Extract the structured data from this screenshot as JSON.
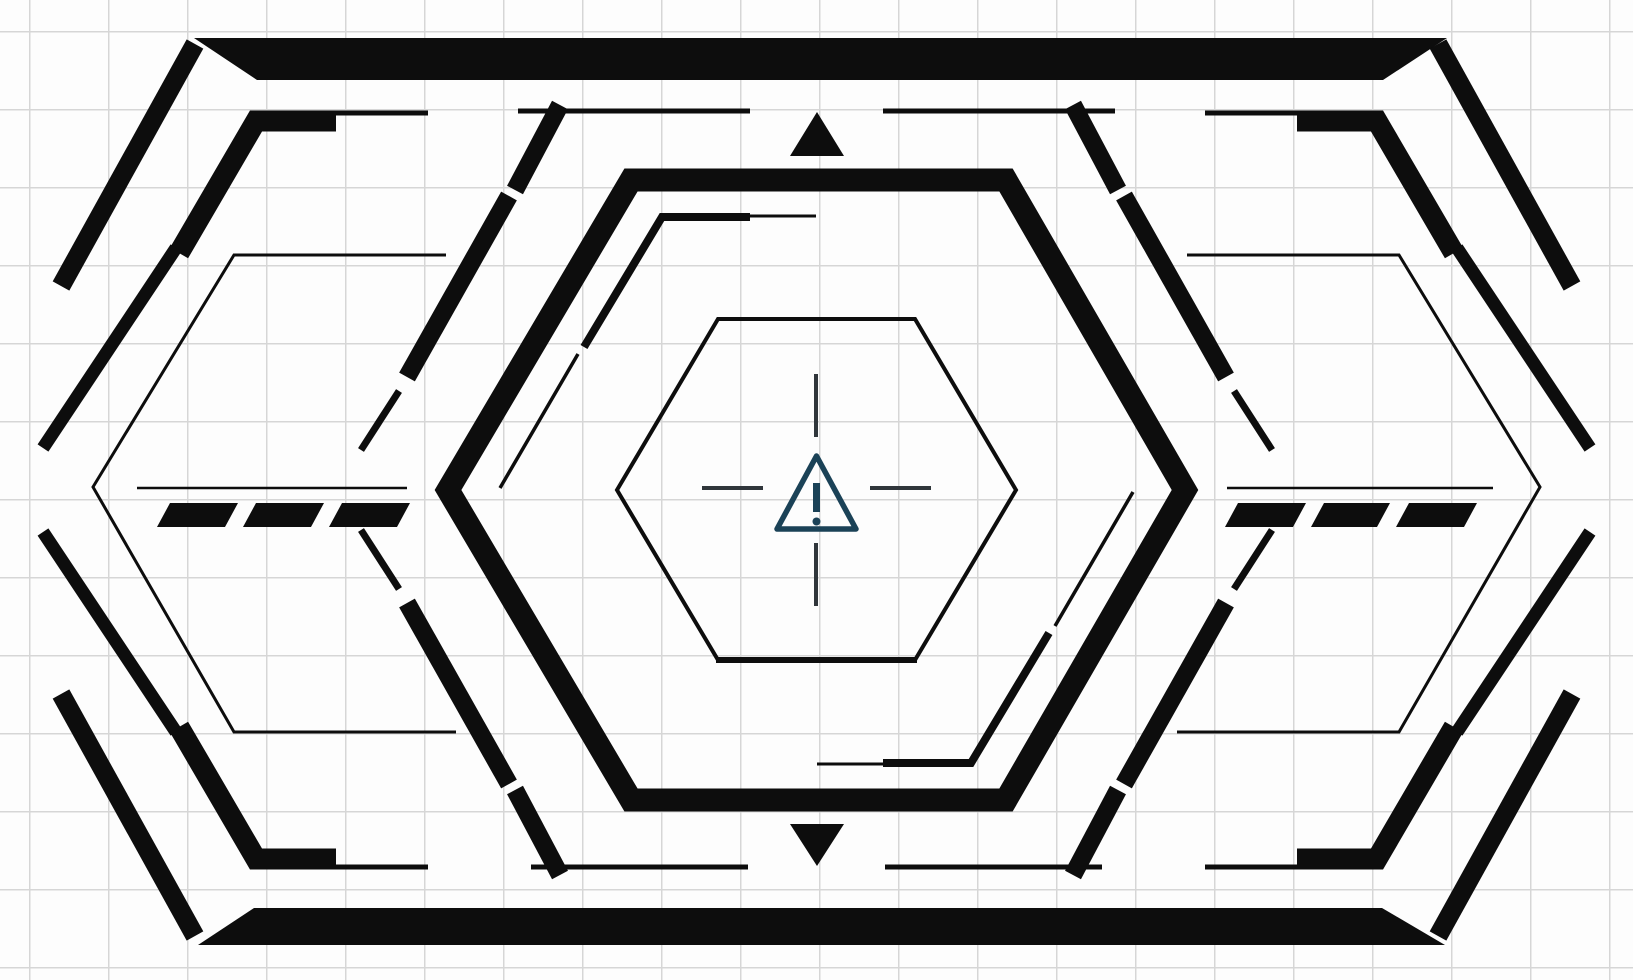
{
  "scene": {
    "title": "Sci-fi HUD hexagonal frame with warning sign on graph paper",
    "canvas": {
      "width": 1633,
      "height": 980
    },
    "colors": {
      "background": "#fdfdfd",
      "grid_line": "#d6d6d6",
      "ink": "#0d0d0d",
      "crosshair": "#30363b",
      "warning": "#1b4257"
    },
    "grid": {
      "cell_w": 79,
      "cell_h": 78,
      "offset_x": 29,
      "offset_y": 31
    },
    "icons": {
      "center": "warning-triangle-icon",
      "top": "up-arrow-icon",
      "bottom": "down-arrow-icon"
    }
  },
  "geometry": {
    "shapes": [
      {
        "name": "top-bar",
        "type": "fill",
        "points": [
          [
            194,
            38
          ],
          [
            1447,
            38
          ],
          [
            1383,
            80
          ],
          [
            257,
            80
          ]
        ]
      },
      {
        "name": "bottom-bar",
        "type": "fill",
        "points": [
          [
            254,
            908
          ],
          [
            1382,
            908
          ],
          [
            1445,
            945
          ],
          [
            198,
            945
          ]
        ]
      },
      {
        "name": "up-arrow-icon",
        "type": "fill",
        "points": [
          [
            817,
            112
          ],
          [
            844,
            156
          ],
          [
            790,
            156
          ]
        ]
      },
      {
        "name": "down-arrow-icon",
        "type": "fill",
        "points": [
          [
            790,
            824
          ],
          [
            844,
            824
          ],
          [
            817,
            866
          ]
        ]
      },
      {
        "name": "dash-left-1",
        "type": "fill",
        "points": [
          [
            170,
            503
          ],
          [
            238,
            503
          ],
          [
            225,
            527
          ],
          [
            157,
            527
          ]
        ]
      },
      {
        "name": "dash-left-2",
        "type": "fill",
        "points": [
          [
            256,
            503
          ],
          [
            324,
            503
          ],
          [
            311,
            527
          ],
          [
            243,
            527
          ]
        ]
      },
      {
        "name": "dash-left-3",
        "type": "fill",
        "points": [
          [
            342,
            503
          ],
          [
            410,
            503
          ],
          [
            397,
            527
          ],
          [
            329,
            527
          ]
        ]
      },
      {
        "name": "dash-right-1",
        "type": "fill",
        "points": [
          [
            1238,
            503
          ],
          [
            1306,
            503
          ],
          [
            1293,
            527
          ],
          [
            1225,
            527
          ]
        ]
      },
      {
        "name": "dash-right-2",
        "type": "fill",
        "points": [
          [
            1324,
            503
          ],
          [
            1390,
            503
          ],
          [
            1377,
            527
          ],
          [
            1311,
            527
          ]
        ]
      },
      {
        "name": "dash-right-3",
        "type": "fill",
        "points": [
          [
            1409,
            503
          ],
          [
            1477,
            503
          ],
          [
            1464,
            527
          ],
          [
            1396,
            527
          ]
        ]
      },
      {
        "name": "corner-diagonal-tl",
        "type": "line",
        "w": 19,
        "points": [
          [
            195,
            44
          ],
          [
            61,
            286
          ]
        ]
      },
      {
        "name": "corner-diagonal-tr",
        "type": "line",
        "w": 19,
        "points": [
          [
            1438,
            44
          ],
          [
            1572,
            286
          ]
        ]
      },
      {
        "name": "corner-diagonal-bl",
        "type": "line",
        "w": 19,
        "points": [
          [
            61,
            694
          ],
          [
            195,
            936
          ]
        ]
      },
      {
        "name": "corner-diagonal-br",
        "type": "line",
        "w": 19,
        "points": [
          [
            1572,
            694
          ],
          [
            1438,
            936
          ]
        ]
      },
      {
        "name": "bracket-tl-main",
        "type": "line",
        "w": 21,
        "points": [
          [
            336,
            121
          ],
          [
            256,
            121
          ],
          [
            179,
            253
          ]
        ]
      },
      {
        "name": "bracket-tl-tail",
        "type": "line",
        "w": 13,
        "points": [
          [
            176,
            248
          ],
          [
            43,
            448
          ]
        ]
      },
      {
        "name": "bracket-tl-thin",
        "type": "line",
        "w": 5,
        "points": [
          [
            334,
            113
          ],
          [
            428,
            113
          ]
        ]
      },
      {
        "name": "bracket-tr-main",
        "type": "line",
        "w": 21,
        "points": [
          [
            1297,
            121
          ],
          [
            1377,
            121
          ],
          [
            1454,
            253
          ]
        ]
      },
      {
        "name": "bracket-tr-tail",
        "type": "line",
        "w": 13,
        "points": [
          [
            1457,
            248
          ],
          [
            1590,
            448
          ]
        ]
      },
      {
        "name": "bracket-tr-thin",
        "type": "line",
        "w": 5,
        "points": [
          [
            1205,
            113
          ],
          [
            1299,
            113
          ]
        ]
      },
      {
        "name": "bracket-bl-main",
        "type": "line",
        "w": 21,
        "points": [
          [
            336,
            859
          ],
          [
            256,
            859
          ],
          [
            179,
            727
          ]
        ]
      },
      {
        "name": "bracket-bl-tail",
        "type": "line",
        "w": 13,
        "points": [
          [
            176,
            732
          ],
          [
            43,
            532
          ]
        ]
      },
      {
        "name": "bracket-bl-thin",
        "type": "line",
        "w": 5,
        "points": [
          [
            334,
            867
          ],
          [
            428,
            867
          ]
        ]
      },
      {
        "name": "bracket-br-main",
        "type": "line",
        "w": 21,
        "points": [
          [
            1297,
            859
          ],
          [
            1377,
            859
          ],
          [
            1454,
            727
          ]
        ]
      },
      {
        "name": "bracket-br-tail",
        "type": "line",
        "w": 13,
        "points": [
          [
            1457,
            732
          ],
          [
            1590,
            532
          ]
        ]
      },
      {
        "name": "bracket-br-thin",
        "type": "line",
        "w": 5,
        "points": [
          [
            1205,
            867
          ],
          [
            1299,
            867
          ]
        ]
      },
      {
        "name": "segment-top-left",
        "type": "line",
        "w": 5,
        "points": [
          [
            518,
            111
          ],
          [
            750,
            111
          ]
        ]
      },
      {
        "name": "segment-top-right",
        "type": "line",
        "w": 5,
        "points": [
          [
            883,
            111
          ],
          [
            1115,
            111
          ]
        ]
      },
      {
        "name": "segment-bottom-left",
        "type": "line",
        "w": 5,
        "points": [
          [
            531,
            867
          ],
          [
            748,
            867
          ]
        ]
      },
      {
        "name": "segment-bottom-right",
        "type": "line",
        "w": 5,
        "points": [
          [
            885,
            867
          ],
          [
            1102,
            867
          ]
        ]
      },
      {
        "name": "thin-hexagon-left",
        "type": "line",
        "w": 3,
        "points": [
          [
            446,
            255
          ],
          [
            234,
            255
          ],
          [
            93,
            487
          ],
          [
            234,
            732
          ],
          [
            456,
            732
          ]
        ]
      },
      {
        "name": "thin-hexagon-right",
        "type": "line",
        "w": 3,
        "points": [
          [
            1187,
            255
          ],
          [
            1399,
            255
          ],
          [
            1540,
            487
          ],
          [
            1399,
            732
          ],
          [
            1177,
            732
          ]
        ]
      },
      {
        "name": "flank-tl-a",
        "type": "line",
        "w": 18,
        "points": [
          [
            560,
            105
          ],
          [
            515,
            190
          ]
        ]
      },
      {
        "name": "flank-tl-b",
        "type": "line",
        "w": 18,
        "points": [
          [
            509,
            196
          ],
          [
            407,
            377
          ]
        ]
      },
      {
        "name": "flank-tl-c",
        "type": "line",
        "w": 7,
        "points": [
          [
            399,
            391
          ],
          [
            361,
            450
          ]
        ]
      },
      {
        "name": "flank-tr-a",
        "type": "line",
        "w": 18,
        "points": [
          [
            1073,
            105
          ],
          [
            1118,
            190
          ]
        ]
      },
      {
        "name": "flank-tr-b",
        "type": "line",
        "w": 18,
        "points": [
          [
            1124,
            196
          ],
          [
            1226,
            377
          ]
        ]
      },
      {
        "name": "flank-tr-c",
        "type": "line",
        "w": 7,
        "points": [
          [
            1234,
            391
          ],
          [
            1272,
            450
          ]
        ]
      },
      {
        "name": "flank-bl-a",
        "type": "line",
        "w": 18,
        "points": [
          [
            560,
            875
          ],
          [
            515,
            790
          ]
        ]
      },
      {
        "name": "flank-bl-b",
        "type": "line",
        "w": 18,
        "points": [
          [
            509,
            784
          ],
          [
            407,
            603
          ]
        ]
      },
      {
        "name": "flank-bl-c",
        "type": "line",
        "w": 7,
        "points": [
          [
            399,
            589
          ],
          [
            361,
            530
          ]
        ]
      },
      {
        "name": "flank-br-a",
        "type": "line",
        "w": 18,
        "points": [
          [
            1073,
            875
          ],
          [
            1118,
            790
          ]
        ]
      },
      {
        "name": "flank-br-b",
        "type": "line",
        "w": 18,
        "points": [
          [
            1124,
            784
          ],
          [
            1226,
            603
          ]
        ]
      },
      {
        "name": "flank-br-c",
        "type": "line",
        "w": 7,
        "points": [
          [
            1234,
            589
          ],
          [
            1272,
            530
          ]
        ]
      },
      {
        "name": "hexagon-middle",
        "type": "outline",
        "w": 23,
        "points": [
          [
            631,
            180
          ],
          [
            1006,
            180
          ],
          [
            1185,
            490
          ],
          [
            1006,
            800
          ],
          [
            631,
            800
          ],
          [
            448,
            490
          ]
        ]
      },
      {
        "name": "inner-bracket-tl-thin",
        "type": "line",
        "w": 3,
        "points": [
          [
            816,
            216
          ],
          [
            748,
            216
          ]
        ]
      },
      {
        "name": "inner-bracket-tl-main",
        "type": "line",
        "w": 8,
        "points": [
          [
            750,
            217
          ],
          [
            662,
            217
          ],
          [
            584,
            347
          ]
        ]
      },
      {
        "name": "inner-bracket-tl-tail",
        "type": "line",
        "w": 3.5,
        "points": [
          [
            578,
            354
          ],
          [
            500,
            488
          ]
        ]
      },
      {
        "name": "inner-bracket-br-thin",
        "type": "line",
        "w": 3,
        "points": [
          [
            817,
            764
          ],
          [
            885,
            764
          ]
        ]
      },
      {
        "name": "inner-bracket-br-main",
        "type": "line",
        "w": 8,
        "points": [
          [
            883,
            763
          ],
          [
            971,
            763
          ],
          [
            1049,
            633
          ]
        ]
      },
      {
        "name": "inner-bracket-br-tail",
        "type": "line",
        "w": 3.5,
        "points": [
          [
            1055,
            626
          ],
          [
            1133,
            492
          ]
        ]
      },
      {
        "name": "hexagon-inner",
        "type": "outline",
        "w": 4,
        "points": [
          [
            718,
            319
          ],
          [
            915,
            319
          ],
          [
            1016,
            490
          ],
          [
            915,
            660
          ],
          [
            718,
            660
          ],
          [
            617,
            490
          ]
        ]
      },
      {
        "name": "hexagon-inner-bottom-edge",
        "type": "line",
        "w": 6,
        "points": [
          [
            716,
            660
          ],
          [
            917,
            660
          ]
        ]
      },
      {
        "name": "dash-guide-left",
        "type": "line",
        "w": 2.5,
        "points": [
          [
            137,
            488
          ],
          [
            407,
            488
          ]
        ]
      },
      {
        "name": "dash-guide-right",
        "type": "line",
        "w": 2.5,
        "points": [
          [
            1227,
            488
          ],
          [
            1493,
            488
          ]
        ]
      },
      {
        "name": "crosshair-tick-top",
        "type": "line",
        "w": 4,
        "color": "crosshair",
        "points": [
          [
            816,
            374
          ],
          [
            816,
            437
          ]
        ]
      },
      {
        "name": "crosshair-tick-bottom",
        "type": "line",
        "w": 4,
        "color": "crosshair",
        "points": [
          [
            816,
            543
          ],
          [
            816,
            606
          ]
        ]
      },
      {
        "name": "crosshair-tick-left",
        "type": "line",
        "w": 4,
        "color": "crosshair",
        "points": [
          [
            702,
            488
          ],
          [
            763,
            488
          ]
        ]
      },
      {
        "name": "crosshair-tick-right",
        "type": "line",
        "w": 4,
        "color": "crosshair",
        "points": [
          [
            870,
            488
          ],
          [
            931,
            488
          ]
        ]
      },
      {
        "name": "warning-triangle-icon",
        "type": "outline",
        "w": 5.5,
        "color": "warning",
        "join": "round",
        "points": [
          [
            816.5,
            456
          ],
          [
            856,
            529
          ],
          [
            777,
            529
          ]
        ]
      },
      {
        "name": "warning-exclamation-bar",
        "type": "line",
        "w": 7,
        "color": "warning",
        "points": [
          [
            816.5,
            483
          ],
          [
            816.5,
            512
          ]
        ]
      },
      {
        "name": "warning-exclamation-dot",
        "type": "circle",
        "color": "warning",
        "cx": 816.5,
        "cy": 521.5,
        "r": 4
      }
    ]
  }
}
